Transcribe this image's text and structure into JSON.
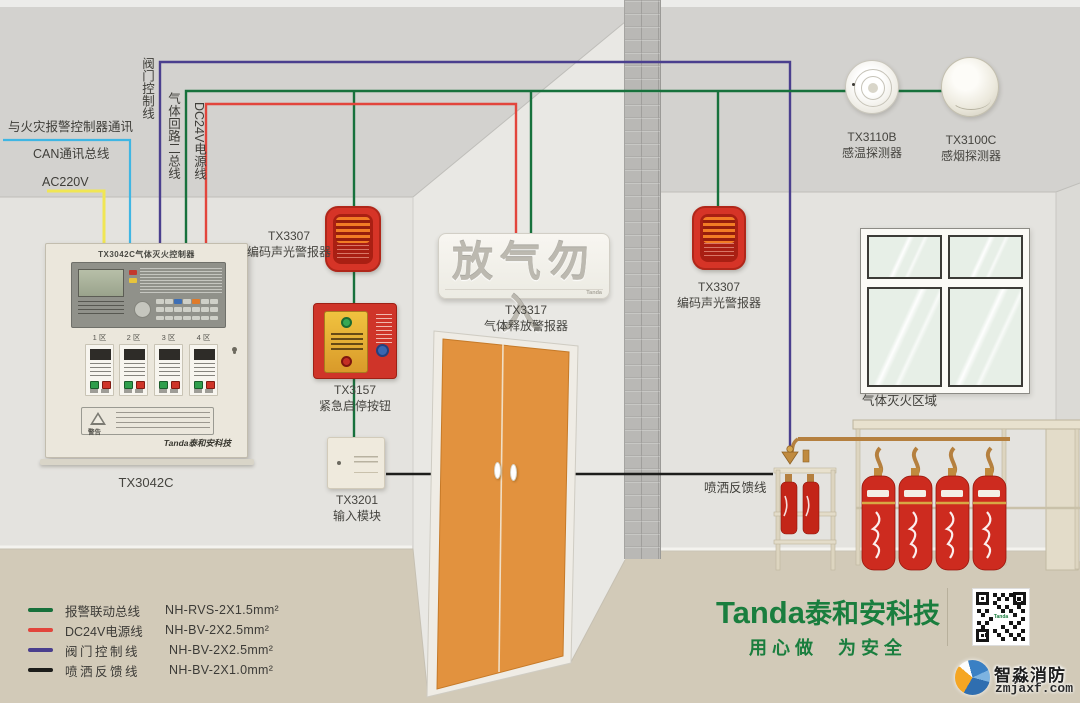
{
  "wiring": {
    "comm_label": "与火灾报警控制器通讯",
    "can_label": "CAN通讯总线",
    "ac_label": "AC220V",
    "valve_label": "阀门控制线",
    "gas_loop_label": "气体回路二总线",
    "dc24v_label": "DC24V电源线",
    "spray_feedback_label": "喷洒反馈线",
    "colors": {
      "can": "#3fb6e3",
      "ac220v": "#f0e654",
      "valve": "#4a3f8e",
      "gas_loop": "#17713c",
      "dc24v": "#e2453c",
      "spray_feedback": "#1d1d1b"
    }
  },
  "panel": {
    "title": "TX3042C气体灭火控制器",
    "zones": [
      "1 区",
      "2 区",
      "3 区",
      "4 区"
    ],
    "warning": "警告",
    "brand": "Tanda泰和安科技",
    "model": "TX3042C"
  },
  "devices": {
    "alarm_left": {
      "model": "TX3307",
      "name": "编码声光警报器"
    },
    "stop_button": {
      "model": "TX3157",
      "name": "紧急启停按钮"
    },
    "input_module": {
      "model": "TX3201",
      "name": "输入模块"
    },
    "release_sign": {
      "text": "放气勿入",
      "model": "TX3317",
      "name": "气体释放警报器",
      "brand": "Tanda"
    },
    "alarm_right": {
      "model": "TX3307",
      "name": "编码声光警报器"
    },
    "heat_detector": {
      "model": "TX3110B",
      "name": "感温探测器"
    },
    "smoke_detector": {
      "model": "TX3100C",
      "name": "感烟探测器"
    },
    "zone_label": "气体灭火区域"
  },
  "legend": {
    "items": [
      {
        "label": "报警联动总线",
        "spec": "NH-RVS-2X1.5mm²",
        "color": "#17713c"
      },
      {
        "label": "DC24V电源线",
        "spec": "NH-BV-2X2.5mm²",
        "color": "#e2453c"
      },
      {
        "label": "阀门控制线",
        "spec": "NH-BV-2X2.5mm²",
        "color": "#4a3f8e"
      },
      {
        "label": "喷洒反馈线",
        "spec": "NH-BV-2X1.0mm²",
        "color": "#1d1d1b"
      }
    ]
  },
  "footer": {
    "brand_en": "Tanda",
    "brand_cn": "泰和安科技",
    "slogan": "用心做  为安全",
    "qr_logo": "Tanda"
  },
  "watermark": {
    "name": "智淼消防",
    "site": "zmjaxf.com"
  }
}
